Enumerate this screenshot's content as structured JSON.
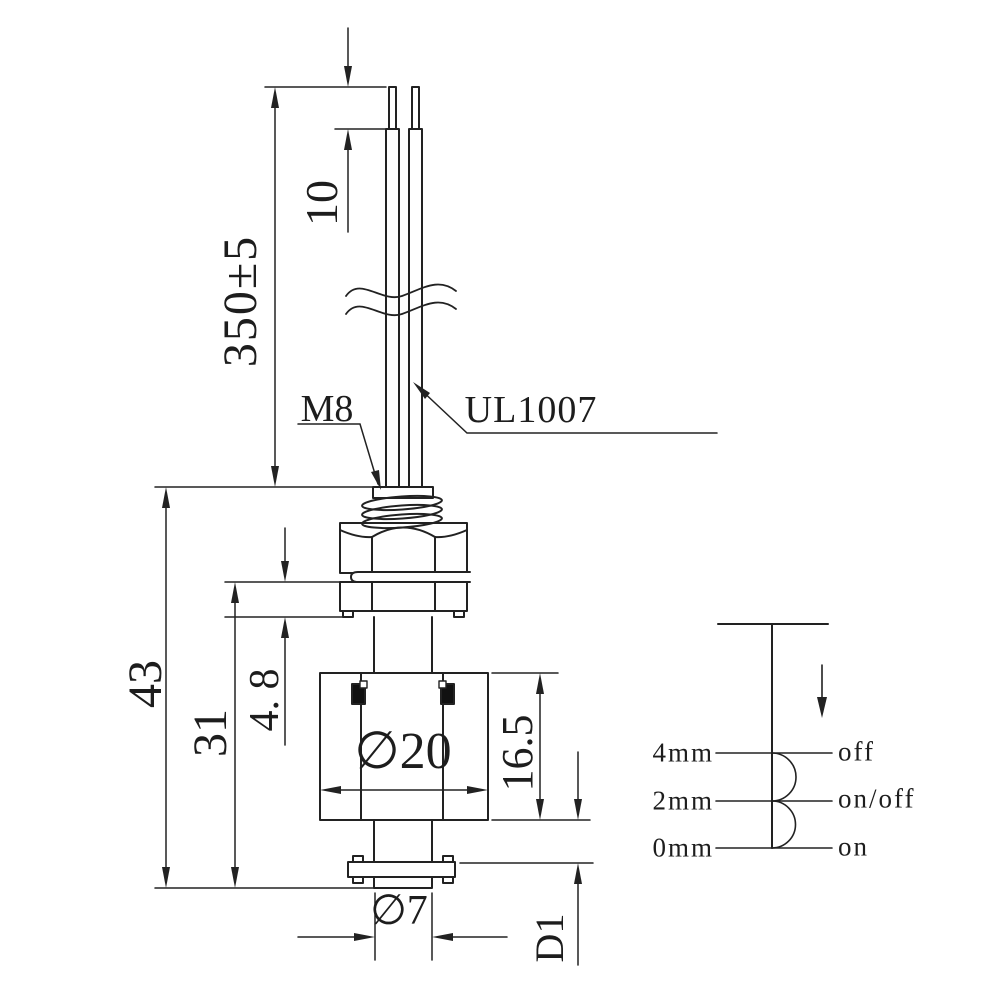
{
  "dimensions": {
    "strip_length": "10",
    "cable_length": "350±5",
    "thread_size": "M8",
    "wire_type": "UL1007",
    "overall_height": "43",
    "body_height": "31",
    "collar_height": "4. 8",
    "float_diameter": "∅20",
    "float_height": "16.5",
    "stem_diameter": "∅7",
    "float_travel": "D1"
  },
  "switch_chart": {
    "levels": [
      {
        "position": "4mm",
        "state": "off"
      },
      {
        "position": "2mm",
        "state": "on/off"
      },
      {
        "position": "0mm",
        "state": "on"
      }
    ]
  }
}
